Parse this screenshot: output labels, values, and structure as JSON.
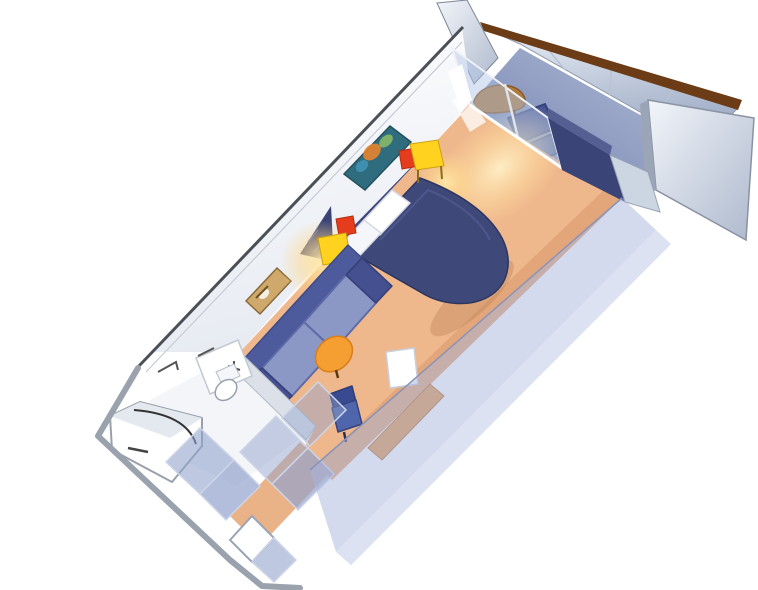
{
  "meta": {
    "description": "3D cutaway rendering of a cruise ship balcony stateroom floor plan"
  },
  "colors": {
    "background": "#ffffff",
    "carpet": "#efb78c",
    "carpet_shadow": "#c98f63",
    "glow": "#ffe8a8",
    "bed": "#3f4979",
    "bed_edge": "#2c3560",
    "pillow": "#ffffff",
    "headboard_panel": "#3e4880",
    "nightstand": "#ffd21f",
    "lamp": "#e63c1e",
    "sofa_cushion": "#8b97c4",
    "sofa_frame": "#4d5a9c",
    "ottoman": "#f59e31",
    "desk_chair": "#5066ac",
    "desk": "#e09a55",
    "tv": "#ffffff",
    "wall_face": "#fbfcfe",
    "wall_edge": "#4b4f56",
    "near_wall": "#a9b6dc",
    "near_wall_light": "#c9d3ea",
    "glass_door": "#aec0e4",
    "divider_wall": "#3b4476",
    "balcony_floor": "#7c89b6",
    "railing_cap": "#6b3c16",
    "partition": "#ccd5e2",
    "deck_chair_brown": "#b07a3c",
    "balcony_chair": "#455393",
    "balcony_red": "#d84a20",
    "bathroom_floor": "#f3f5f9",
    "fixture": "#ffffff",
    "closet_glass": "#93a3cd",
    "entry_door": "#ffffff",
    "artwork_reef": "#2f6d7e",
    "artwork_gold": "#cfa96b"
  }
}
